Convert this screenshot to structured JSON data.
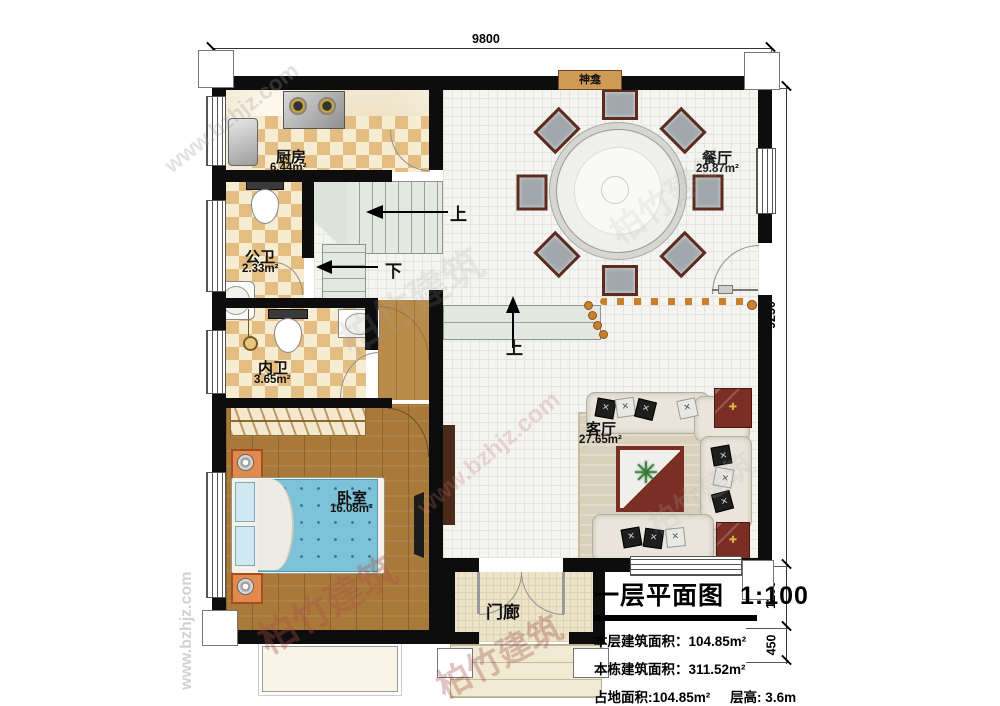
{
  "title_block": {
    "title": "一层平面图",
    "scale": "1:100",
    "stats": [
      "本层建筑面积：104.85m²",
      "本栋建筑面积：311.52m²",
      "占地面积:104.85m²",
      "层高: 3.6m"
    ]
  },
  "dimensions": {
    "width_top": "9800",
    "height_right": "9250",
    "porch_offset": "1200",
    "steps_offset": "450"
  },
  "rooms": {
    "kitchen": {
      "name": "厨房",
      "area": "6.44m²"
    },
    "public_bath": {
      "name": "公卫",
      "area": "2.33m²"
    },
    "inner_bath": {
      "name": "内卫",
      "area": "3.65m²"
    },
    "bedroom": {
      "name": "卧室",
      "area": "16.08m²"
    },
    "dining": {
      "name": "餐厅",
      "area": "29.87m²"
    },
    "living": {
      "name": "客厅",
      "area": "27.65m²"
    },
    "porch": {
      "name": "门廊"
    }
  },
  "annotations": {
    "shrine": "神龛",
    "stairs_up": "上",
    "stairs_down": "下",
    "steps_up": "上"
  },
  "watermark": {
    "cn": "柏竹建筑",
    "url": "www.bzhjz.com"
  },
  "colors": {
    "wall": "#0d0d0d",
    "checker_tile": "#e3bd82",
    "wood_floor": "#a9793a",
    "mattress_blue": "#7ec2d8",
    "shrine_bg": "#cf9a55",
    "platform_dot": "#c8802f",
    "accent_red": "#7b2f24"
  }
}
